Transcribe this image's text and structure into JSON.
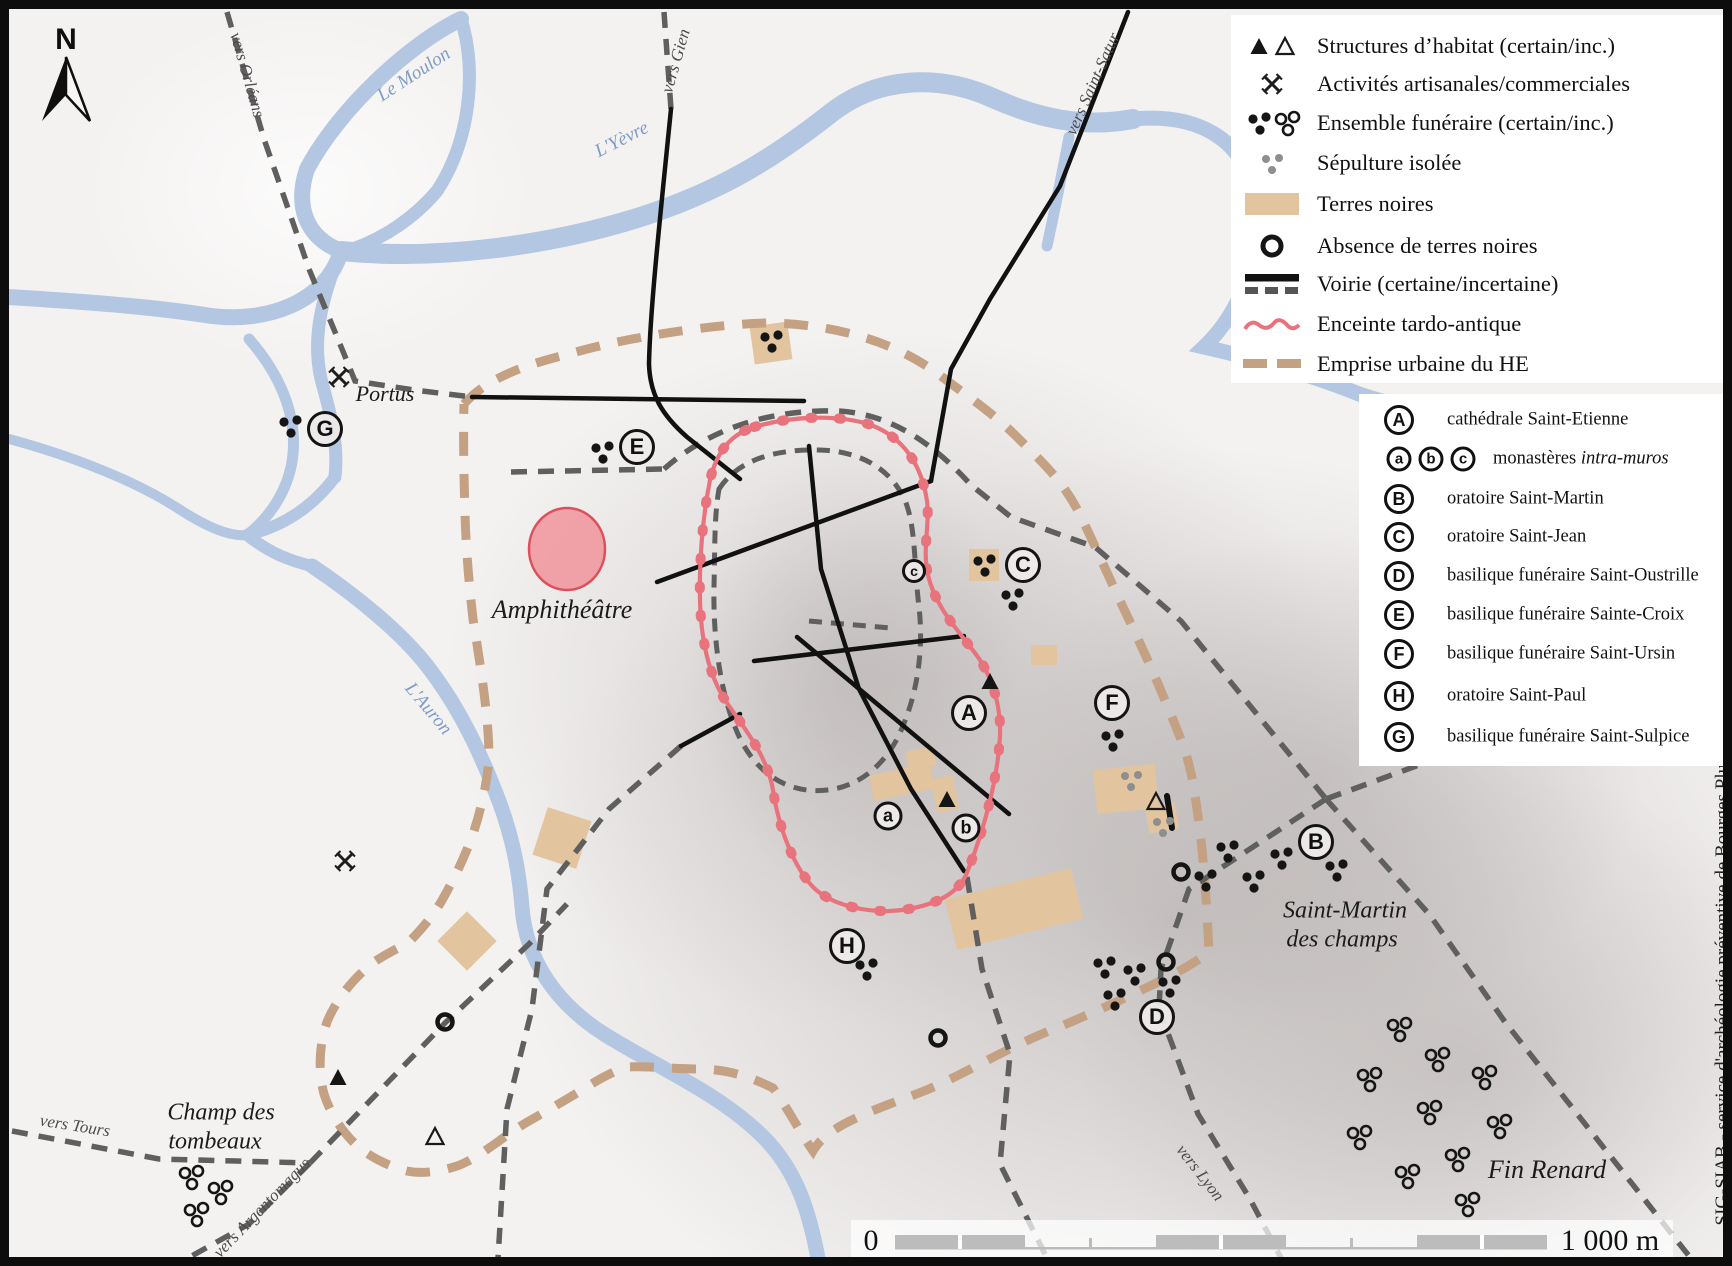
{
  "map": {
    "north_label": "N",
    "credit": "SIG-SIAB - service d'archéologie préventive de Bourges Plus",
    "scalebar": {
      "zero": "0",
      "distance": "1 000 m"
    },
    "colors": {
      "water": "#b3c7e2",
      "terres_noires": "#e2c59e",
      "emprise": "#c4a183",
      "enceinte": "#e8737c",
      "road_certain": "#111111",
      "road_incertain": "#5f5f5f"
    },
    "labels": [
      {
        "id": "portus",
        "text": "Portus",
        "x": 376,
        "y": 385,
        "rot": 0,
        "size": 22,
        "cls": ""
      },
      {
        "id": "amphitheatre",
        "text": "Amphithéâtre",
        "x": 553,
        "y": 601,
        "rot": 0,
        "size": 26,
        "cls": ""
      },
      {
        "id": "champ-des-tombeaux-1",
        "text": "Champ des",
        "x": 212,
        "y": 1104,
        "rot": 0,
        "size": 24,
        "cls": ""
      },
      {
        "id": "champ-des-tombeaux-2",
        "text": "tombeaux",
        "x": 206,
        "y": 1133,
        "rot": 0,
        "size": 24,
        "cls": ""
      },
      {
        "id": "saint-martin-1",
        "text": "Saint-Martin",
        "x": 1336,
        "y": 902,
        "rot": 0,
        "size": 24,
        "cls": ""
      },
      {
        "id": "saint-martin-2",
        "text": "des champs",
        "x": 1333,
        "y": 931,
        "rot": 0,
        "size": 24,
        "cls": ""
      },
      {
        "id": "fin-renard",
        "text": "Fin Renard",
        "x": 1538,
        "y": 1161,
        "rot": 0,
        "size": 26,
        "cls": ""
      },
      {
        "id": "le-moulon",
        "text": "Le Moulon",
        "x": 405,
        "y": 66,
        "rot": -33,
        "size": 19,
        "cls": "water"
      },
      {
        "id": "l-yevre",
        "text": "L'Yèvre",
        "x": 613,
        "y": 131,
        "rot": -27,
        "size": 19,
        "cls": "water"
      },
      {
        "id": "l-auron",
        "text": "L'Auron",
        "x": 419,
        "y": 700,
        "rot": 50,
        "size": 19,
        "cls": "water"
      },
      {
        "id": "vers-orleans",
        "text": "vers Orléans",
        "x": 238,
        "y": 66,
        "rot": 74,
        "size": 17,
        "cls": "road"
      },
      {
        "id": "vers-gien",
        "text": "vers Gien",
        "x": 667,
        "y": 52,
        "rot": -74,
        "size": 17,
        "cls": "road"
      },
      {
        "id": "vers-saint-satur",
        "text": "vers Saint-Satur",
        "x": 1084,
        "y": 75,
        "rot": -66,
        "size": 17,
        "cls": "road"
      },
      {
        "id": "vers-nevers",
        "text": "vers Nevers",
        "x": 1638,
        "y": 685,
        "rot": -13,
        "size": 18,
        "cls": "road"
      },
      {
        "id": "vers-lyon",
        "text": "vers Lyon",
        "x": 1191,
        "y": 1164,
        "rot": 52,
        "size": 17,
        "cls": "road"
      },
      {
        "id": "vers-tours",
        "text": "vers Tours",
        "x": 66,
        "y": 1117,
        "rot": 9,
        "size": 17,
        "cls": "road"
      },
      {
        "id": "vers-argentomagus",
        "text": "vers Argentomagus",
        "x": 253,
        "y": 1199,
        "rot": -46,
        "size": 17,
        "cls": "road"
      }
    ],
    "placemarks": [
      {
        "k": "A",
        "x": 960,
        "y": 704,
        "s": "lg"
      },
      {
        "k": "B",
        "x": 1307,
        "y": 833,
        "s": "lg"
      },
      {
        "k": "C",
        "x": 1014,
        "y": 556,
        "s": "lg"
      },
      {
        "k": "D",
        "x": 1148,
        "y": 1008,
        "s": "lg"
      },
      {
        "k": "E",
        "x": 628,
        "y": 438,
        "s": "lg"
      },
      {
        "k": "F",
        "x": 1103,
        "y": 694,
        "s": "lg"
      },
      {
        "k": "G",
        "x": 316,
        "y": 420,
        "s": "lg"
      },
      {
        "k": "H",
        "x": 838,
        "y": 937,
        "s": "lg"
      },
      {
        "k": "a",
        "x": 879,
        "y": 807,
        "s": "sm"
      },
      {
        "k": "b",
        "x": 957,
        "y": 819,
        "s": "sm"
      },
      {
        "k": "c",
        "x": 905,
        "y": 562,
        "s": "xs"
      }
    ]
  },
  "legend_symbols": {
    "items": [
      {
        "label": "Structures d’habitat (certain/inc.)"
      },
      {
        "label": "Activités artisanales/commerciales"
      },
      {
        "label": "Ensemble funéraire (certain/inc.)"
      },
      {
        "label": "Sépulture isolée"
      },
      {
        "label": "Terres noires"
      },
      {
        "label": "Absence de terres noires"
      },
      {
        "label": "Voirie (certaine/incertaine)"
      },
      {
        "label": "Enceinte tardo-antique"
      },
      {
        "label": "Emprise urbaine du HE"
      }
    ]
  },
  "legend_letters": {
    "items": [
      {
        "key": "A",
        "label": "cathédrale Saint-Etienne"
      },
      {
        "key": "abc",
        "key_a": "a",
        "key_b": "b",
        "key_c": "c",
        "label": "monastères ",
        "label_italic": "intra-muros"
      },
      {
        "key": "B",
        "label": "oratoire Saint-Martin"
      },
      {
        "key": "C",
        "label": "oratoire Saint-Jean"
      },
      {
        "key": "D",
        "label": "basilique funéraire Saint-Oustrille"
      },
      {
        "key": "E",
        "label": "basilique funéraire Sainte-Croix"
      },
      {
        "key": "F",
        "label": "basilique funéraire Saint-Ursin"
      },
      {
        "key": "H",
        "label": "oratoire Saint-Paul"
      },
      {
        "key": "G",
        "label": "basilique funéraire Saint-Sulpice"
      }
    ]
  }
}
